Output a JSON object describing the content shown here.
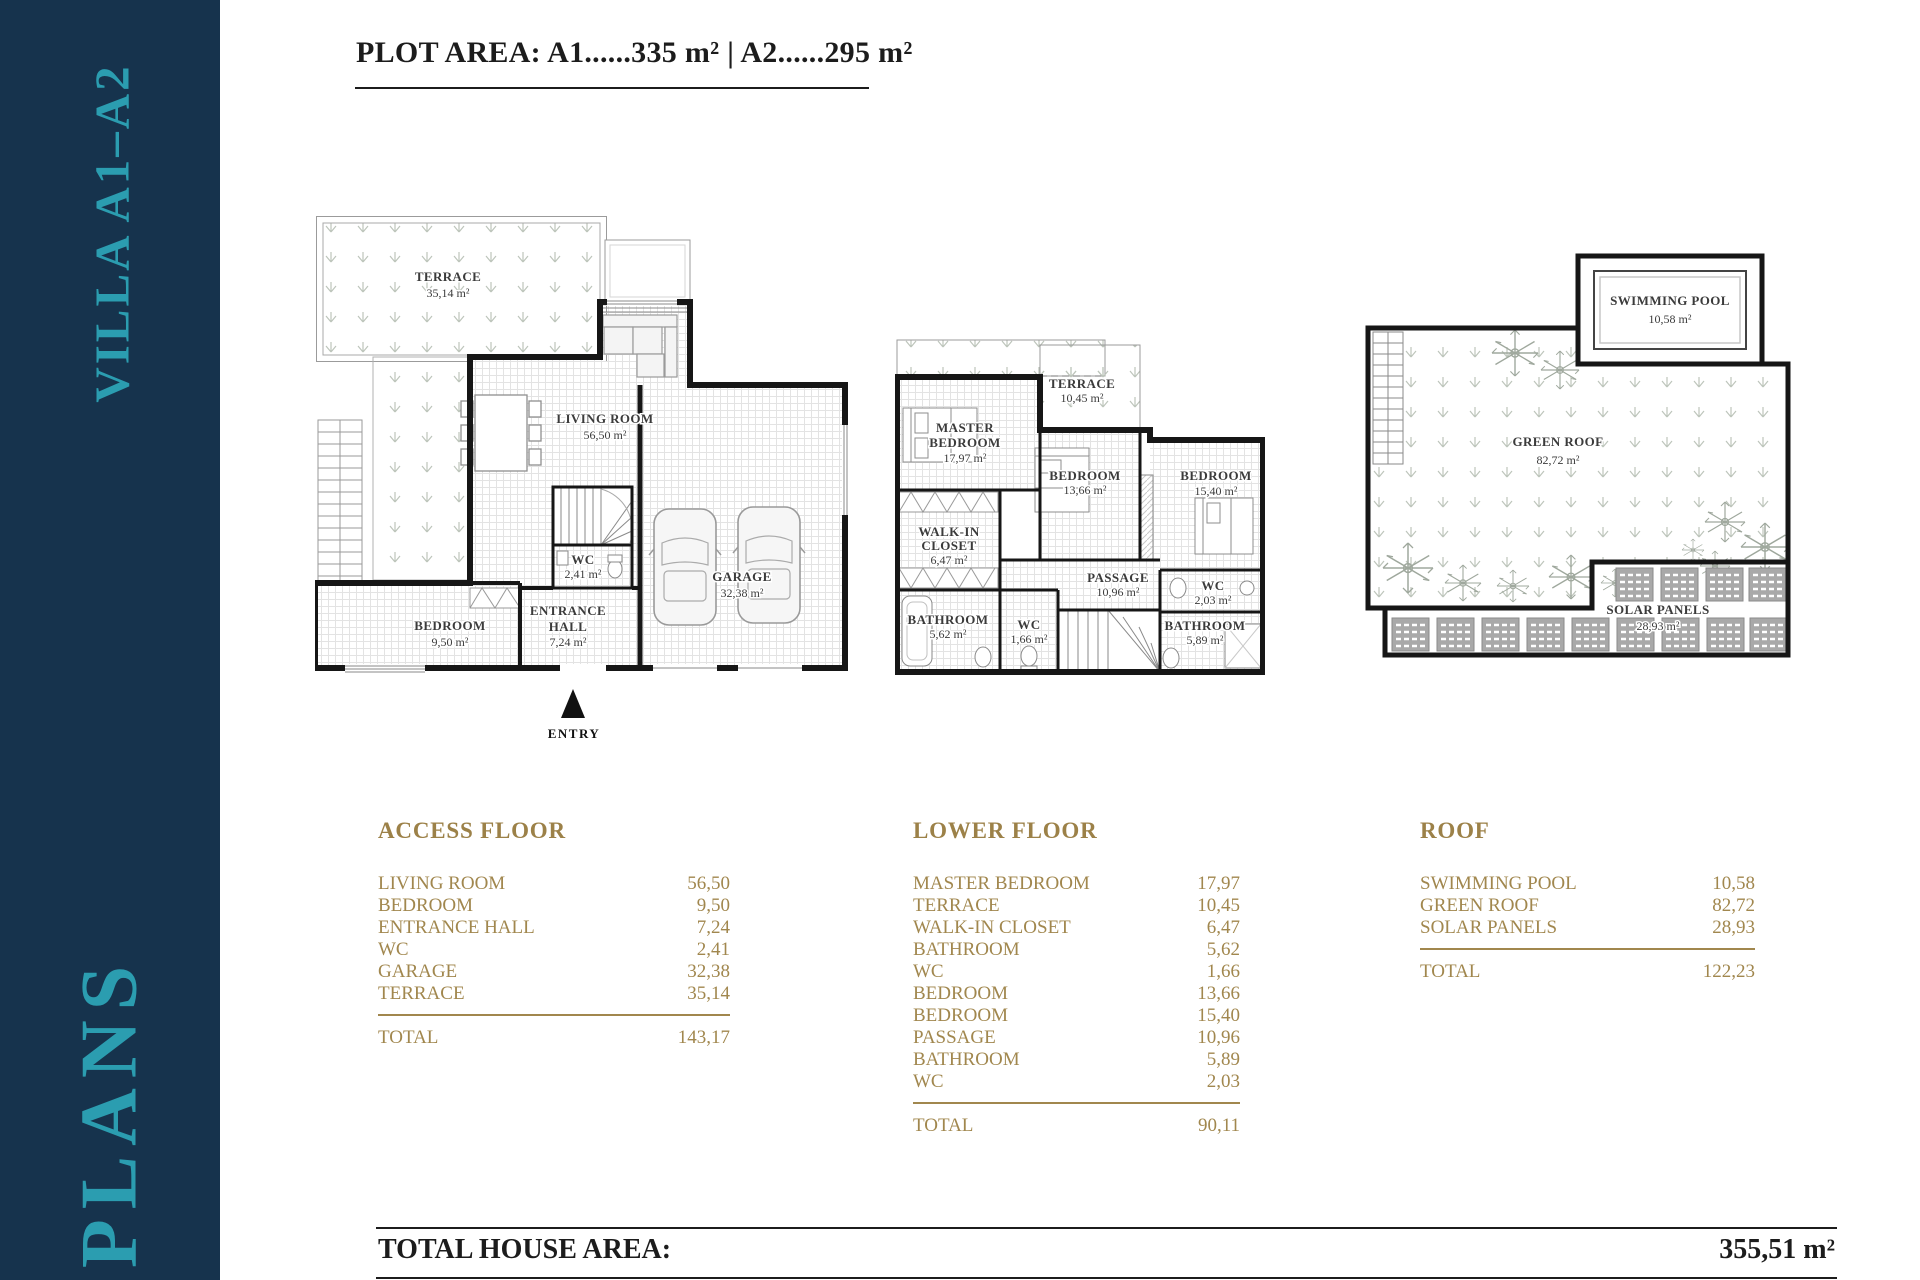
{
  "sidebar": {
    "project": "VILLA A1–A2",
    "section": "PLANS",
    "bg_color": "#16334d",
    "accent_color": "#2b9db0"
  },
  "header": {
    "plot_area": "PLOT AREA: A1......335 m²   |   A2......295 m²"
  },
  "plans": {
    "access": {
      "terrace_name": "TERRACE",
      "terrace_area": "35,14 m²",
      "living_name": "LIVING ROOM",
      "living_area": "56,50 m²",
      "wc_name": "WC",
      "wc_area": "2,41 m²",
      "entrance_name1": "ENTRANCE",
      "entrance_name2": "HALL",
      "entrance_area": "7,24 m²",
      "bedroom_name": "BEDROOM",
      "bedroom_area": "9,50 m²",
      "garage_name": "GARAGE",
      "garage_area": "32,38 m²",
      "entry_label": "ENTRY"
    },
    "lower": {
      "terrace_name": "TERRACE",
      "terrace_area": "10,45 m²",
      "master_name1": "MASTER",
      "master_name2": "BEDROOM",
      "master_area": "17,97 m²",
      "bedroom1_name": "BEDROOM",
      "bedroom1_area": "13,66 m²",
      "bedroom2_name": "BEDROOM",
      "bedroom2_area": "15,40 m²",
      "walkin_name1": "WALK-IN",
      "walkin_name2": "CLOSET",
      "walkin_area": "6,47 m²",
      "bathroom1_name": "BATHROOM",
      "bathroom1_area": "5,62 m²",
      "wc1_name": "WC",
      "wc1_area": "1,66 m²",
      "passage_name": "PASSAGE",
      "passage_area": "10,96 m²",
      "wc2_name": "WC",
      "wc2_area": "2,03 m²",
      "bathroom2_name": "BATHROOM",
      "bathroom2_area": "5,89 m²"
    },
    "roof": {
      "pool_name": "SWIMMING POOL",
      "pool_area": "10,58 m²",
      "green_name": "GREEN ROOF",
      "green_area": "82,72 m²",
      "solar_name": "SOLAR PANELS",
      "solar_area": "28,93 m²"
    }
  },
  "tables": {
    "access": {
      "title": "ACCESS FLOOR",
      "rows": [
        {
          "label": "LIVING ROOM",
          "value": "56,50"
        },
        {
          "label": "BEDROOM",
          "value": "9,50"
        },
        {
          "label": "ENTRANCE HALL",
          "value": "7,24"
        },
        {
          "label": "WC",
          "value": "2,41"
        },
        {
          "label": "GARAGE",
          "value": "32,38"
        },
        {
          "label": "TERRACE",
          "value": "35,14"
        }
      ],
      "total_label": "TOTAL",
      "total": "143,17"
    },
    "lower": {
      "title": "LOWER FLOOR",
      "rows": [
        {
          "label": "MASTER BEDROOM",
          "value": "17,97"
        },
        {
          "label": "TERRACE",
          "value": "10,45"
        },
        {
          "label": "WALK-IN CLOSET",
          "value": "6,47"
        },
        {
          "label": "BATHROOM",
          "value": "5,62"
        },
        {
          "label": "WC",
          "value": "1,66"
        },
        {
          "label": "BEDROOM",
          "value": "13,66"
        },
        {
          "label": "BEDROOM",
          "value": "15,40"
        },
        {
          "label": "PASSAGE",
          "value": "10,96"
        },
        {
          "label": "BATHROOM",
          "value": "5,89"
        },
        {
          "label": "WC",
          "value": "2,03"
        }
      ],
      "total_label": "TOTAL",
      "total": "90,11"
    },
    "roof": {
      "title": "ROOF",
      "rows": [
        {
          "label": "SWIMMING POOL",
          "value": "10,58"
        },
        {
          "label": "GREEN ROOF",
          "value": "82,72"
        },
        {
          "label": "SOLAR PANELS",
          "value": "28,93"
        }
      ],
      "total_label": "TOTAL",
      "total": "122,23"
    }
  },
  "footer": {
    "label": "TOTAL HOUSE AREA:",
    "value": "355,51 m²"
  }
}
